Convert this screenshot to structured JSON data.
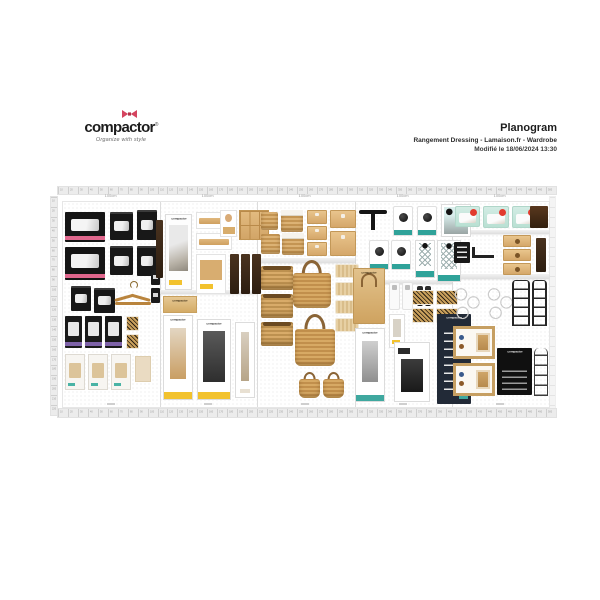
{
  "logo": {
    "brand": "compactor",
    "reg": "®",
    "tagline": "Organize with style",
    "bow_color": "#d5445f"
  },
  "header": {
    "title": "Planogram",
    "subtitle": "Rangement Dressing - Lamaison.fr - Wardrobe",
    "modified": "Modifié le 18/06/2024 13:30"
  },
  "planogram": {
    "brand_label": "compactor",
    "rulers": {
      "top": {
        "length_cm": 500,
        "tick_cm": 10,
        "px_per_tick": 10,
        "ticks": 50
      },
      "bottom": {
        "length_cm": 500,
        "tick_cm": 10,
        "px_per_tick": 10,
        "ticks": 50
      },
      "left": {
        "length_cm": 220,
        "tick_cm": 10,
        "px_per_tick": 10,
        "ticks": 22
      },
      "right": {
        "ticks": 22
      }
    },
    "panels": [
      {
        "id": 1,
        "label": "100cm",
        "category": "vacuum-storage-bags"
      },
      {
        "id": 2,
        "label": "100cm",
        "category": "drawer-organizers"
      },
      {
        "id": 3,
        "label": "100cm",
        "category": "baskets"
      },
      {
        "id": 4,
        "label": "100cm",
        "category": "hooks-and-racks"
      },
      {
        "id": 5,
        "label": "100cm",
        "category": "compression-and-modular"
      }
    ],
    "dividers_x": [
      97,
      194,
      292,
      389
    ],
    "shelves": [
      {
        "x": 195,
        "y": 56,
        "w": 97,
        "h": 5
      },
      {
        "x": 97,
        "y": 88,
        "w": 97,
        "h": 4
      },
      {
        "x": 292,
        "y": 78,
        "w": 97,
        "h": 4
      },
      {
        "x": 390,
        "y": 28,
        "w": 96,
        "h": 4
      },
      {
        "x": 390,
        "y": 72,
        "w": 96,
        "h": 5
      }
    ],
    "captions_y": 201,
    "products": [
      {
        "kind": "black-box-large",
        "x": 2,
        "y": 10,
        "w": 40,
        "h": 30
      },
      {
        "kind": "black-box-large",
        "x": 2,
        "y": 45,
        "w": 40,
        "h": 33
      },
      {
        "kind": "black-box-small",
        "x": 47,
        "y": 10,
        "w": 23,
        "h": 28
      },
      {
        "kind": "black-box-small",
        "x": 47,
        "y": 44,
        "w": 23,
        "h": 29
      },
      {
        "kind": "black-box-small",
        "x": 74,
        "y": 8,
        "w": 20,
        "h": 30
      },
      {
        "kind": "black-box-small",
        "x": 74,
        "y": 44,
        "w": 20,
        "h": 30
      },
      {
        "kind": "black-box-small",
        "x": 8,
        "y": 84,
        "w": 20,
        "h": 25
      },
      {
        "kind": "black-box-small",
        "x": 31,
        "y": 86,
        "w": 21,
        "h": 25
      },
      {
        "kind": "hanger",
        "x": 52,
        "y": 80,
        "w": 36,
        "h": 26
      },
      {
        "kind": "black-card",
        "x": 88,
        "y": 68,
        "w": 9,
        "h": 15
      },
      {
        "kind": "black-card",
        "x": 88,
        "y": 86,
        "w": 9,
        "h": 15
      },
      {
        "kind": "purple-pack",
        "x": 2,
        "y": 114,
        "w": 17,
        "h": 32
      },
      {
        "kind": "purple-pack",
        "x": 22,
        "y": 114,
        "w": 17,
        "h": 32
      },
      {
        "kind": "purple-pack",
        "x": 42,
        "y": 114,
        "w": 17,
        "h": 32
      },
      {
        "kind": "leopard-card",
        "x": 63,
        "y": 114,
        "w": 13,
        "h": 15
      },
      {
        "kind": "leopard-card",
        "x": 63,
        "y": 132,
        "w": 13,
        "h": 15
      },
      {
        "kind": "light-pack",
        "x": 2,
        "y": 152,
        "w": 20,
        "h": 36
      },
      {
        "kind": "light-pack",
        "x": 25,
        "y": 152,
        "w": 20,
        "h": 36
      },
      {
        "kind": "light-pack",
        "x": 48,
        "y": 152,
        "w": 20,
        "h": 36
      },
      {
        "kind": "tan-card",
        "x": 72,
        "y": 154,
        "w": 16,
        "h": 26
      },
      {
        "kind": "dark-strip",
        "x": 93,
        "y": 18,
        "w": 7,
        "h": 58
      },
      {
        "kind": "display-box",
        "label": "compactor",
        "x": 102,
        "y": 12,
        "w": 27,
        "h": 76
      },
      {
        "kind": "wood-bar-card",
        "x": 133,
        "y": 10,
        "w": 36,
        "h": 17
      },
      {
        "kind": "wood-bar-card",
        "x": 133,
        "y": 31,
        "w": 36,
        "h": 17
      },
      {
        "kind": "face-card",
        "x": 157,
        "y": 8,
        "w": 17,
        "h": 27
      },
      {
        "kind": "wood-square",
        "x": 176,
        "y": 8,
        "w": 30,
        "h": 30
      },
      {
        "kind": "wood-pic-card",
        "x": 133,
        "y": 52,
        "w": 30,
        "h": 40
      },
      {
        "kind": "dark-strip",
        "x": 167,
        "y": 52,
        "w": 9,
        "h": 40
      },
      {
        "kind": "dark-strip",
        "x": 178,
        "y": 52,
        "w": 9,
        "h": 40
      },
      {
        "kind": "dark-strip",
        "x": 189,
        "y": 52,
        "w": 9,
        "h": 40
      },
      {
        "kind": "kraft-box",
        "label": "compactor",
        "x": 100,
        "y": 94,
        "w": 34,
        "h": 17
      },
      {
        "kind": "valet-box",
        "label": "compactor",
        "x": 100,
        "y": 113,
        "w": 30,
        "h": 85
      },
      {
        "kind": "rack-box",
        "label": "compactor",
        "x": 134,
        "y": 117,
        "w": 34,
        "h": 81
      },
      {
        "kind": "coat-box",
        "x": 172,
        "y": 120,
        "w": 20,
        "h": 76
      },
      {
        "kind": "wicker-basket",
        "x": 198,
        "y": 10,
        "w": 17,
        "h": 18
      },
      {
        "kind": "wicker-basket-rim",
        "x": 218,
        "y": 8,
        "w": 22,
        "h": 22
      },
      {
        "kind": "wicker-basket",
        "x": 198,
        "y": 32,
        "w": 19,
        "h": 20
      },
      {
        "kind": "wicker-basket-rim",
        "x": 219,
        "y": 31,
        "w": 22,
        "h": 22
      },
      {
        "kind": "wood-drawer",
        "x": 244,
        "y": 8,
        "w": 20,
        "h": 14
      },
      {
        "kind": "wood-drawer",
        "x": 244,
        "y": 24,
        "w": 20,
        "h": 14
      },
      {
        "kind": "wood-drawer",
        "x": 244,
        "y": 40,
        "w": 20,
        "h": 14
      },
      {
        "kind": "wood-drawer-big",
        "x": 267,
        "y": 8,
        "w": 26,
        "h": 18
      },
      {
        "kind": "wood-drawer-big",
        "x": 267,
        "y": 29,
        "w": 26,
        "h": 25
      },
      {
        "kind": "seagrass-basket",
        "x": 198,
        "y": 64,
        "w": 32,
        "h": 24
      },
      {
        "kind": "seagrass-basket",
        "x": 198,
        "y": 92,
        "w": 32,
        "h": 24
      },
      {
        "kind": "seagrass-basket",
        "x": 198,
        "y": 120,
        "w": 32,
        "h": 24
      },
      {
        "kind": "tote-bag",
        "x": 230,
        "y": 58,
        "w": 38,
        "h": 48
      },
      {
        "kind": "tote-bag",
        "x": 232,
        "y": 112,
        "w": 40,
        "h": 52
      },
      {
        "kind": "tote-bag-small",
        "x": 236,
        "y": 170,
        "w": 21,
        "h": 26
      },
      {
        "kind": "tote-bag-small",
        "x": 260,
        "y": 170,
        "w": 21,
        "h": 26
      },
      {
        "kind": "mat",
        "x": 272,
        "y": 62,
        "w": 24,
        "h": 14
      },
      {
        "kind": "mat",
        "x": 272,
        "y": 80,
        "w": 24,
        "h": 14
      },
      {
        "kind": "mat",
        "x": 272,
        "y": 98,
        "w": 24,
        "h": 14
      },
      {
        "kind": "mat",
        "x": 272,
        "y": 116,
        "w": 24,
        "h": 14
      },
      {
        "kind": "hook-bar",
        "x": 296,
        "y": 6,
        "w": 28,
        "h": 24
      },
      {
        "kind": "knob-blister",
        "x": 330,
        "y": 4,
        "w": 20,
        "h": 30
      },
      {
        "kind": "knob-blister",
        "x": 354,
        "y": 4,
        "w": 20,
        "h": 30
      },
      {
        "kind": "appliance-card",
        "x": 378,
        "y": 2,
        "w": 30,
        "h": 33
      },
      {
        "kind": "knob-blister",
        "x": 306,
        "y": 38,
        "w": 20,
        "h": 30
      },
      {
        "kind": "knob-blister",
        "x": 328,
        "y": 38,
        "w": 20,
        "h": 30
      },
      {
        "kind": "teal-rack-card",
        "x": 352,
        "y": 38,
        "w": 20,
        "h": 38
      },
      {
        "kind": "teal-rack-card",
        "x": 374,
        "y": 38,
        "w": 24,
        "h": 42
      },
      {
        "kind": "kraft-bag",
        "label": "compactor",
        "x": 290,
        "y": 66,
        "w": 32,
        "h": 56
      },
      {
        "kind": "tube-card",
        "x": 326,
        "y": 80,
        "w": 11,
        "h": 28
      },
      {
        "kind": "tube-card",
        "x": 339,
        "y": 80,
        "w": 11,
        "h": 28
      },
      {
        "kind": "battery-pair",
        "x": 353,
        "y": 84,
        "w": 16,
        "h": 20
      },
      {
        "kind": "leopard-mat",
        "x": 349,
        "y": 88,
        "w": 22,
        "h": 15
      },
      {
        "kind": "leopard-mat",
        "x": 373,
        "y": 88,
        "w": 22,
        "h": 15
      },
      {
        "kind": "leopard-mat",
        "x": 349,
        "y": 106,
        "w": 22,
        "h": 15
      },
      {
        "kind": "leopard-mat",
        "x": 373,
        "y": 106,
        "w": 22,
        "h": 15
      },
      {
        "kind": "small-display-card",
        "x": 326,
        "y": 112,
        "w": 16,
        "h": 34
      },
      {
        "kind": "coatrack-box",
        "label": "compactor",
        "x": 292,
        "y": 126,
        "w": 30,
        "h": 74
      },
      {
        "kind": "trolley-box",
        "x": 331,
        "y": 140,
        "w": 36,
        "h": 60
      },
      {
        "kind": "navy-box",
        "label": "compactor",
        "x": 374,
        "y": 112,
        "w": 34,
        "h": 90
      },
      {
        "kind": "mint-pack",
        "x": 392,
        "y": 4,
        "w": 25,
        "h": 21
      },
      {
        "kind": "mint-pack",
        "x": 420,
        "y": 4,
        "w": 26,
        "h": 22
      },
      {
        "kind": "mint-pack",
        "x": 449,
        "y": 4,
        "w": 26,
        "h": 22
      },
      {
        "kind": "darkwood-card",
        "x": 467,
        "y": 4,
        "w": 18,
        "h": 22
      },
      {
        "kind": "black-pack",
        "x": 391,
        "y": 40,
        "w": 16,
        "h": 21
      },
      {
        "kind": "wall-hook",
        "x": 409,
        "y": 45,
        "w": 22,
        "h": 11
      },
      {
        "kind": "wood-drawer-knob",
        "x": 440,
        "y": 33,
        "w": 28,
        "h": 12
      },
      {
        "kind": "wood-drawer-knob",
        "x": 440,
        "y": 47,
        "w": 28,
        "h": 12
      },
      {
        "kind": "wood-drawer-knob",
        "x": 440,
        "y": 61,
        "w": 28,
        "h": 12
      },
      {
        "kind": "dark-strip",
        "x": 473,
        "y": 36,
        "w": 10,
        "h": 34
      },
      {
        "kind": "honeycomb",
        "x": 391,
        "y": 82,
        "w": 27,
        "h": 40
      },
      {
        "kind": "honeycomb",
        "x": 424,
        "y": 82,
        "w": 27,
        "h": 40
      },
      {
        "kind": "wire-rack",
        "x": 449,
        "y": 78,
        "w": 18,
        "h": 46
      },
      {
        "kind": "wire-rack",
        "x": 469,
        "y": 78,
        "w": 15,
        "h": 46
      },
      {
        "kind": "frame-box",
        "x": 390,
        "y": 124,
        "w": 42,
        "h": 33
      },
      {
        "kind": "frame-box",
        "x": 390,
        "y": 161,
        "w": 42,
        "h": 33
      },
      {
        "kind": "black-big-box",
        "label": "compactor",
        "x": 434,
        "y": 146,
        "w": 35,
        "h": 47
      },
      {
        "kind": "arch-wire",
        "x": 471,
        "y": 146,
        "w": 14,
        "h": 48
      }
    ]
  }
}
